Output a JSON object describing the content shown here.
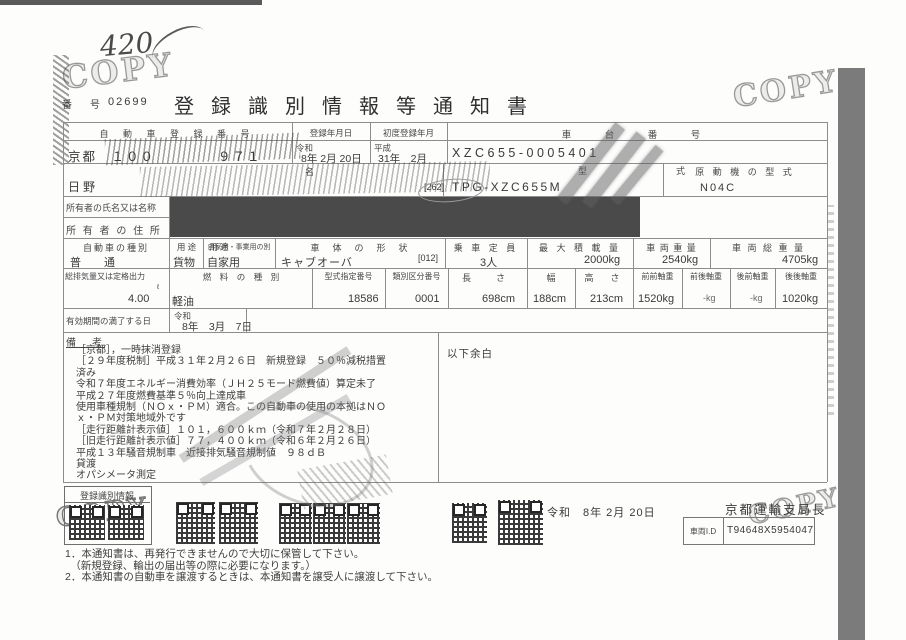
{
  "colors": {
    "ink": "#3c3c3c",
    "redaction": "#4a4a4a",
    "side_bar": "#7b7b7b",
    "stamp_gray": "#8b8b8b"
  },
  "page": {
    "handwritten_number": "420",
    "copy_stamp": "COPY",
    "doc_number_label": "番　号",
    "doc_number": "02699",
    "title": "登録識別情報等通知書"
  },
  "table": {
    "reg_number": {
      "label": "自 動 車 登 録 番 号",
      "value_left": "京都　１００",
      "value_right": "９７１"
    },
    "reg_date": {
      "label": "登録年月日",
      "era": "令和",
      "value": "8年  2月 20日"
    },
    "first_reg": {
      "label": "初度登録年月",
      "era": "平成",
      "value": "31年　2月"
    },
    "chassis": {
      "label": "車　台　番　号",
      "value": "XZC655-0005401"
    },
    "name": {
      "label": "名",
      "value": "日野"
    },
    "model": {
      "label": "型　式",
      "prefix": "[262]",
      "value": "TPG-XZC655M"
    },
    "engine_model": {
      "label": "原 動 機 の 型 式",
      "value": "N04C"
    },
    "owner_name_label": "所有者の氏名又は名称",
    "owner_addr_label": "所 有 者 の 住 所",
    "spec": {
      "category": {
        "label": "自動車の種別",
        "value": "普　通"
      },
      "use": {
        "label": "用 途",
        "value": "貨物"
      },
      "private": {
        "label": "自家用・事業用の別",
        "value": "自家用"
      },
      "body": {
        "label": "車　体　の　形　状",
        "value": "キャブオーバ",
        "code": "[012]"
      },
      "capacity": {
        "label": "乗 車 定 員",
        "value": "3人"
      },
      "max_load": {
        "label": "最 大 積 載 量",
        "value": "2000kg"
      },
      "weight": {
        "label": "車 両 重 量",
        "value": "2540kg"
      },
      "gross_weight": {
        "label": "車 両 総 重 量",
        "value": "4705kg"
      }
    },
    "spec2": {
      "displacement": {
        "label": "総排気量又は定格出力",
        "unit": "ℓ",
        "value": "4.00"
      },
      "fuel": {
        "label": "燃　料　の　種　別",
        "value": "軽油"
      },
      "type_no": {
        "label": "型式指定番号",
        "value": "18586"
      },
      "class_no": {
        "label": "類別区分番号",
        "value": "0001"
      },
      "length": {
        "label": "長　さ",
        "value": "698cm"
      },
      "width": {
        "label": "幅",
        "value": "188cm"
      },
      "height": {
        "label": "高　さ",
        "value": "213cm"
      },
      "axle_ff": {
        "label": "前前軸重",
        "value": "1520kg"
      },
      "axle_fr": {
        "label": "前後軸重",
        "value": "-kg"
      },
      "axle_rf": {
        "label": "後前軸重",
        "value": "-kg"
      },
      "axle_rr": {
        "label": "後後軸重",
        "value": "1020kg"
      }
    },
    "expiry": {
      "label": "有効期間の満了する日",
      "era": "令和",
      "value": "8年　3月　7日"
    },
    "remarks": {
      "label": "備　考",
      "blank_note": "以下余白",
      "lines": [
        "［京都］，一時抹消登録",
        "［２９年度税制］平成３１年２月２６日　新規登録　５０％減税措置",
        "済み",
        "令和７年度エネルギー消費効率（ＪＨ２５モード燃費値）算定未了",
        "平成２７年度燃費基準５％向上達成車",
        "使用車種規制（ＮＯｘ・ＰＭ）適合。この自動車の使用の本拠はＮＯ",
        "ｘ・ＰＭ対策地域外です",
        "［走行距離計表示値］１０１，６００ｋｍ（令和７年２月２８日）",
        "［旧走行距離計表示値］７７，４００ｋｍ（令和６年２月２６日）",
        "平成１３年騒音規制車　近接排気騒音規制値　９８ｄＢ",
        "貸渡",
        "オパシメータ測定"
      ]
    }
  },
  "bottom": {
    "qr_box_label": "登録識別情報",
    "issue_date": "令和　8年  2月 20日",
    "authority": "京都運輸支局長",
    "vehicle_id_label": "車両I.D",
    "vehicle_id": "T94648X5954047"
  },
  "footnotes": [
    "1．本通知書は、再発行できませんので大切に保管して下さい。",
    "　（新規登録、輸出の届出等の際に必要になります。）",
    "2．本通知書の自動車を譲渡するときは、本通知書を譲受人に譲渡して下さい。"
  ]
}
